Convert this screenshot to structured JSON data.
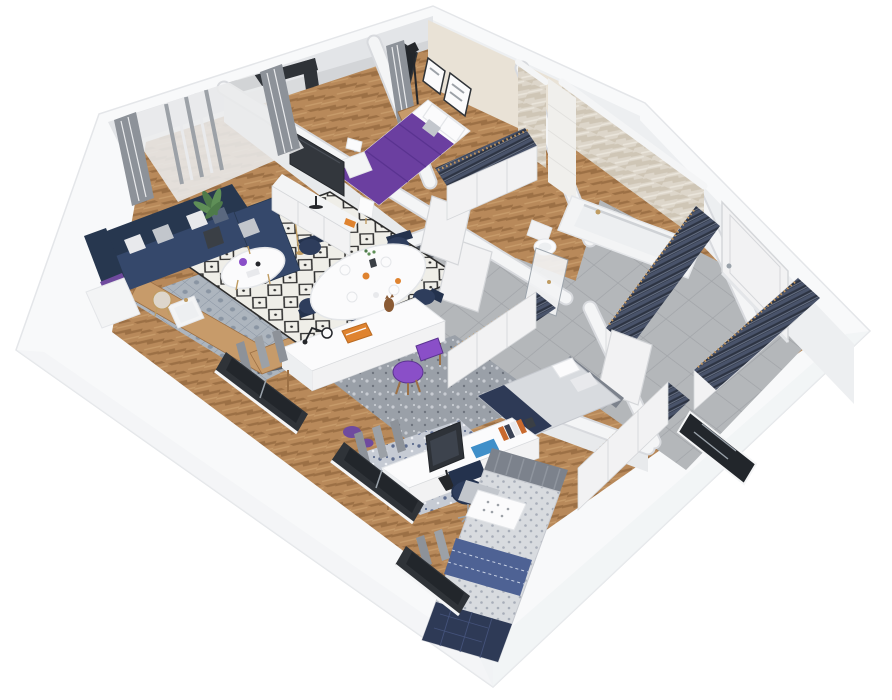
{
  "scene": {
    "type": "isometric-3d-floorplan-render",
    "description": "Cutaway 3D rendering of a furnished apartment viewed from above at an angle, white background, no visible text",
    "width": 892,
    "height": 700
  },
  "rooms": [
    {
      "id": "living-room",
      "label": "Living room with kitchenette and dining area",
      "furniture": [
        "navy-corner-sofa",
        "throw-pillows",
        "purple-throw",
        "diamond-pattern-rug",
        "round-coffee-table",
        "purple-vase",
        "oval-dining-table",
        "navy-dining-chairs",
        "table-setting",
        "tv-console",
        "flat-tv",
        "table-lamp",
        "floor-lamp",
        "potted-plant",
        "side-table",
        "side-cabinet",
        "kitchen-counter",
        "sink",
        "cooktop",
        "kettle",
        "sheer-curtains",
        "gray-drapes"
      ]
    },
    {
      "id": "balcony",
      "label": "Balcony with orange chair and small wooden desk",
      "furniture": [
        "orange-chair",
        "wooden-desk",
        "glazed-door-frame",
        "parapet"
      ]
    },
    {
      "id": "master-bedroom",
      "label": "Master bedroom with purple bed",
      "furniture": [
        "double-bed-purple-duvet",
        "white-pillows",
        "wall-art-frames",
        "mirror",
        "gray-curtain",
        "black-floor-lamp",
        "wood-nightstand",
        "white-nightstand",
        "bedside-lamp",
        "open-wardrobe-with-clothes"
      ]
    },
    {
      "id": "bathroom",
      "label": "Bathroom with herringbone tiled walls",
      "furniture": [
        "bathtub",
        "gold-faucet",
        "toilet",
        "shower-tile-column",
        "glass-shower-door"
      ]
    },
    {
      "id": "hallway",
      "label": "Entrance hallway with gray tile floor",
      "furniture": [
        "entrance-door",
        "open-wardrobe-with-clothes",
        "second-open-wardrobe",
        "dark-glazed-door",
        "interior-doors"
      ]
    },
    {
      "id": "office-bedroom",
      "label": "Second bedroom / office with dark slate walls",
      "furniture": [
        "white-desk",
        "desk-lamp",
        "orange-book",
        "cat-figurine",
        "purple-chair",
        "single-bed",
        "white-pillows",
        "navy-throw",
        "speckled-rug",
        "purple-slippers",
        "open-wardrobe-with-clothes"
      ]
    },
    {
      "id": "third-bedroom",
      "label": "Third bedroom with desk and blue bed",
      "furniture": [
        "desk",
        "monitor",
        "laptop",
        "blue-poster",
        "books",
        "game-controllers",
        "navy-swivel-chair",
        "striped-headboard",
        "dotted-duvet-bed",
        "polka-dot-pillow",
        "blue-blanket",
        "navy-quilt",
        "speckled-blue-rug",
        "open-wardrobe-with-clothes",
        "window"
      ]
    }
  ],
  "palette": {
    "bg": "#ffffff",
    "shell": "#f8f9fa",
    "shellEdge": "#e4e6e9",
    "shellShade": "#eff1f3",
    "wood": "#b8895a",
    "woodDark": "#9c7045",
    "woodLight": "#c79b6a",
    "tile": "#b4b7ba",
    "tileLine": "#a1a4a8",
    "ktile": "#adb5be",
    "ktileDot": "#8a95a3",
    "wallTop": "#f4f5f6",
    "wallUnder": "#d8dade",
    "wallFace": "#e8eaec",
    "neFace": "#edeff1",
    "cream": "#e9e2d6",
    "slate": "#575c64",
    "rugBase": "#efeee8",
    "rugLine": "#2d2d2d",
    "sofa": "#35486b",
    "sofaDark": "#27374f",
    "cushionLight": "#e8e9ec",
    "cushionMid": "#c2c6cc",
    "cushionDark": "#5a687f",
    "purpleBed": "#6b3fa0",
    "purpleDeep": "#5a3390",
    "purpleChair": "#8a4fc8",
    "purpleThrow": "#6f4a9e",
    "navySeat": "#2e3d5c",
    "navyBack": "#24324d",
    "orange": "#df832f",
    "orangeDark": "#b96a22",
    "tvDark": "#33373d",
    "tvEdge": "#23262a",
    "monitor": "#2e3238",
    "monitorScreen": "#3d434d",
    "screenBlue": "#3f8fc9",
    "white": "#fbfbfc",
    "offwhite": "#f3f4f5",
    "clothesDark": "#2c3342",
    "clothesMid": "#49536a",
    "clothesHi": "#6a7488",
    "hanger": "#c49860",
    "bathTileBg": "#ddd6ca",
    "bathTileA": "#cfc6b6",
    "bathTileB": "#eae5db",
    "showerTile": "#f0efec",
    "curtain": "#9ca1a7",
    "curtainLight": "#e9eaec",
    "drape": "#8d9299",
    "frameDark": "#2f3338",
    "glassBlack": "#22262b",
    "metal": "#9aa2aa",
    "plant": "#4e7a4a",
    "plantLight": "#5f8f57",
    "pot": "#3a3f45",
    "blanket": "#4e6294",
    "blanketLine": "#c9d2e4",
    "quilt": "#2e3a56",
    "quiltLine": "#44527a",
    "duvet": "#d8dbdf",
    "duvetDot": "#a7adb8",
    "headboard": "#7c828c",
    "headboardLine": "#8f959e",
    "gold": "#bf9c62",
    "doorWhite": "#f2f2f3",
    "doorEdge": "#d5d7da",
    "balconyFloor": "#d3d5d8",
    "parapetFace": "#e3e5e8",
    "sideTable": "#ddd6cb",
    "bookSpine1": "#c96a2e",
    "bookSpine2": "#3a4254",
    "catBrown": "#8a5a34",
    "lampBlack": "#25272b",
    "speck": "#9aa0a8",
    "speckDotA": "#c8ccd2",
    "speckDotB": "#6e747e",
    "bspeck": "#c6cbd4",
    "bspeckDotA": "#5d6c8e",
    "bspeckDotB": "#eef0f4"
  }
}
